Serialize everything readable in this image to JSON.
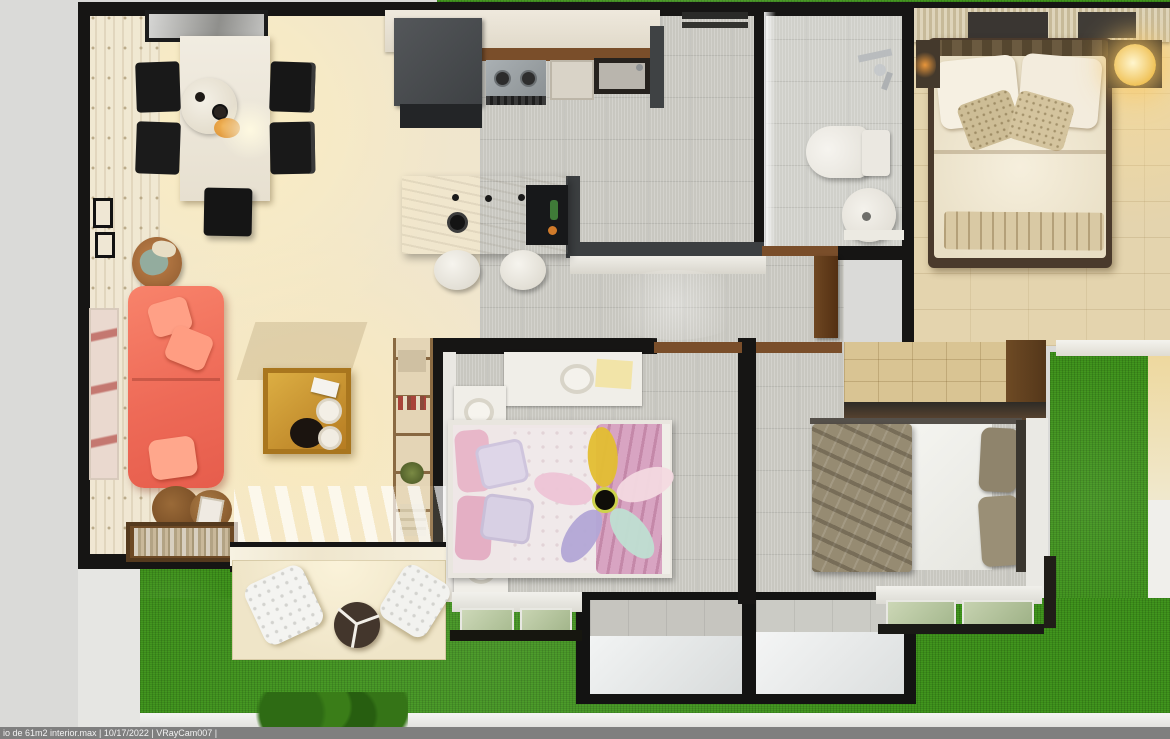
{
  "render_stamp": {
    "text": "io de 61m2 interior.max | 10/17/2022 | VRayCam007 |",
    "file_name": "io de 61m2 interior.max",
    "date": "10/17/2022",
    "camera": "VRayCam007"
  },
  "scene": {
    "type": "top-down 3D architectural render (dollhouse view)",
    "subject": "61 m2 apartment interior floor plan surrounded by lawn",
    "rooms": [
      "living-dining-room",
      "kitchen",
      "laundry-area",
      "bathroom",
      "master-bedroom",
      "kids-bedroom",
      "second-bedroom",
      "corridor",
      "patio",
      "garden"
    ],
    "furniture": {
      "living_dining": [
        "white dining table",
        "round serving tray",
        "black dining chairs x5",
        "marble sideboard",
        "coral sofa with pillows",
        "wooden coffee table with tray and plates",
        "rattan basket with blankets",
        "wall art frames",
        "round side tables",
        "book sideboard",
        "tall bookshelf",
        "sliding glass door"
      ],
      "kitchen": [
        "white counter",
        "dark refrigerator",
        "two-burner cooktop",
        "dark sink",
        "marble island with knobs and tray",
        "white stools x2"
      ],
      "bathroom": [
        "toilet",
        "round basin",
        "shower fixtures"
      ],
      "master_bedroom": [
        "double bed with white duvet and beige pillows",
        "slatted wardrobe",
        "nightstands",
        "glowing bedside lamp"
      ],
      "kids_bedroom": [
        "single bed with pink pillows and pink blanket",
        "flower-shaped ceiling fan",
        "white dresser",
        "white nightstands with lamps",
        "window"
      ],
      "second_bedroom": [
        "bed with khaki blanket and white sheet",
        "khaki pillows",
        "wood-front closet",
        "window"
      ],
      "patio": [
        "white mesh lounge chairs x2",
        "round dark table with Y divider",
        "shrub"
      ]
    }
  },
  "palette": {
    "exterior_gray": "#dadad8",
    "grass_green": "#41961d",
    "wall_black": "#161514",
    "living_floor_cream": "#efe5cd",
    "tile_gray": "#c8c7c0",
    "master_floor_beige": "#e4d4ae",
    "sofa_coral": "#f2705c",
    "coffee_table_gold": "#c9912f",
    "kids_blanket_pink": "#d8a4c2",
    "fan_petal_yellow": "#e3be31",
    "fan_petal_teal": "#bfdfd2",
    "fan_petal_lavender": "#b2a7d6",
    "khaki_blanket": "#968b72",
    "door_wood": "#7a4e2a",
    "stamp_bar_gray": "#7f7f7f"
  }
}
